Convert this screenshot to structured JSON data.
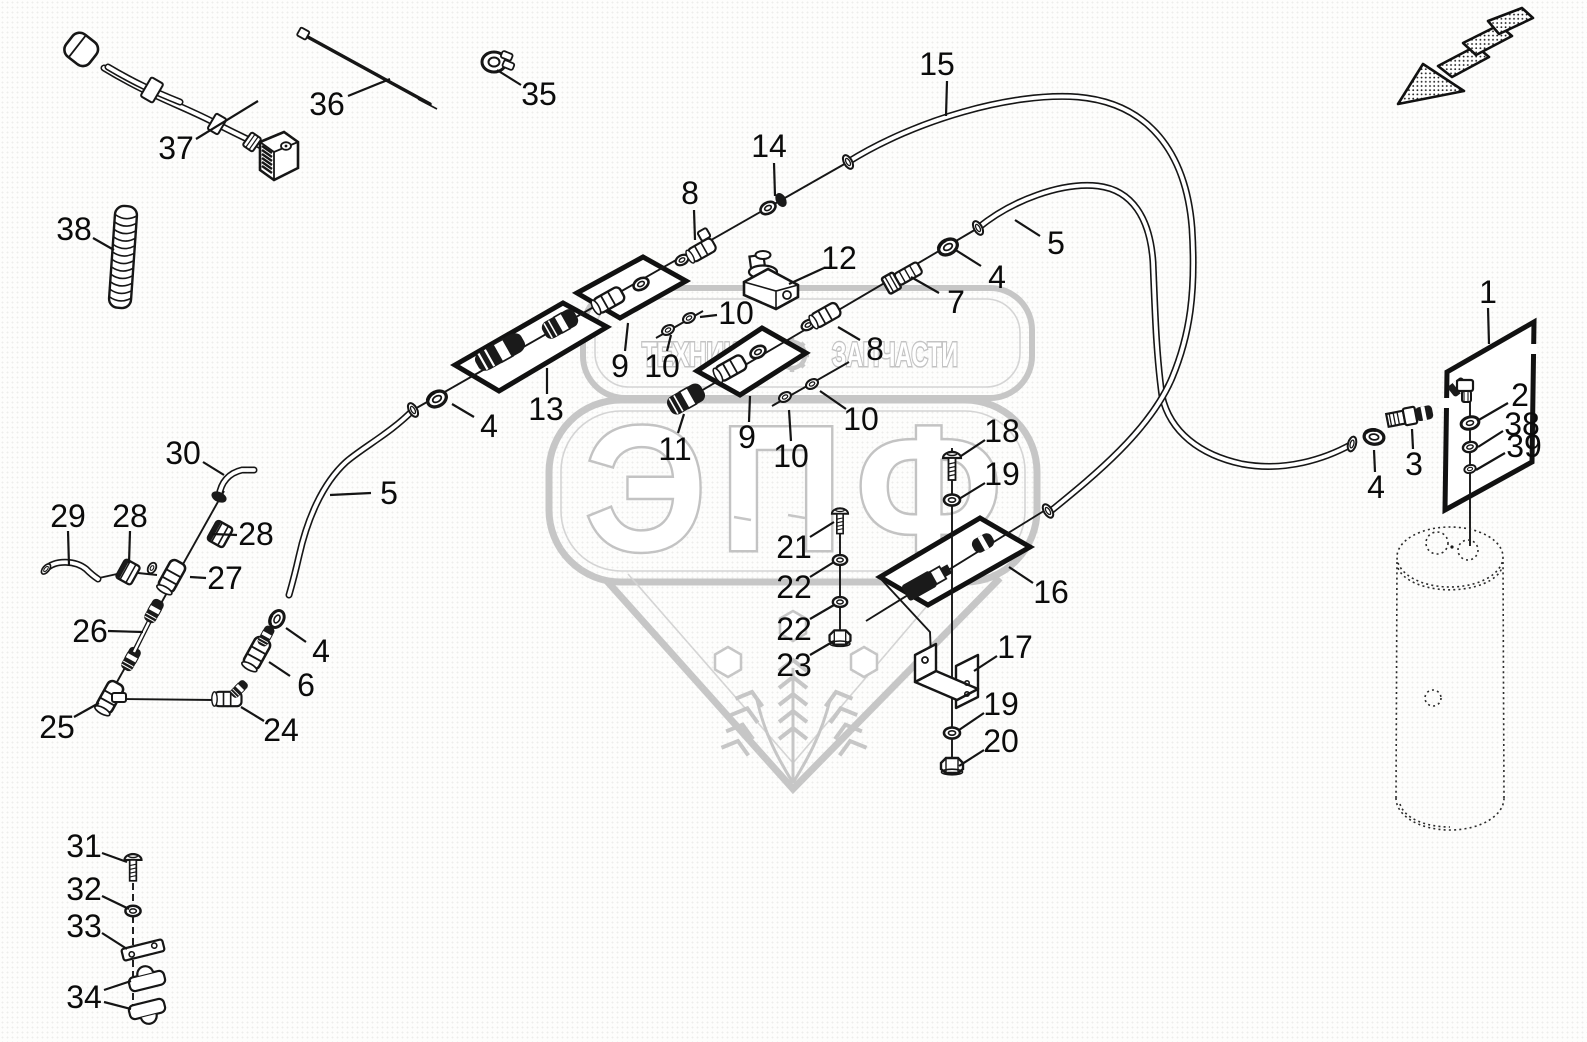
{
  "watermark": {
    "banner_left": "ТЕХНИКА",
    "banner_right": "ЗАПЧАСТИ",
    "brand": "ЭПФ",
    "color": "#c6c6c6"
  },
  "colors": {
    "line": "#161616",
    "label": "#0b0b0b",
    "background": "#fdfdfc"
  },
  "icons": {
    "direction_arrow": "hatched-arrow-down-left"
  },
  "callouts": [
    {
      "n": "37",
      "x": 176,
      "y": 148,
      "l": [
        [
          196,
          139,
          258,
          101
        ]
      ]
    },
    {
      "n": "36",
      "x": 327,
      "y": 104,
      "l": [
        [
          348,
          96,
          390,
          79
        ]
      ]
    },
    {
      "n": "35",
      "x": 539,
      "y": 94,
      "l": [
        [
          521,
          85,
          497,
          70
        ]
      ]
    },
    {
      "n": "38",
      "x": 74,
      "y": 229,
      "l": [
        [
          93,
          238,
          114,
          250
        ]
      ]
    },
    {
      "n": "15",
      "x": 937,
      "y": 64,
      "l": [
        [
          947,
          81,
          946,
          116
        ]
      ]
    },
    {
      "n": "14",
      "x": 769,
      "y": 146,
      "l": [
        [
          774,
          163,
          775,
          196
        ]
      ]
    },
    {
      "n": "8",
      "x": 690,
      "y": 193,
      "l": [
        [
          694,
          210,
          695,
          240
        ]
      ]
    },
    {
      "n": "5",
      "x": 1056,
      "y": 243,
      "l": [
        [
          1040,
          236,
          1015,
          220
        ]
      ]
    },
    {
      "n": "4",
      "x": 997,
      "y": 277,
      "l": [
        [
          981,
          266,
          954,
          249
        ]
      ]
    },
    {
      "n": "7",
      "x": 956,
      "y": 302,
      "l": [
        [
          939,
          293,
          911,
          277
        ]
      ]
    },
    {
      "n": "12",
      "x": 839,
      "y": 258,
      "l": [
        [
          824,
          268,
          789,
          284
        ]
      ]
    },
    {
      "n": "8",
      "x": 875,
      "y": 349,
      "l": [
        [
          860,
          340,
          838,
          327
        ]
      ]
    },
    {
      "n": "10",
      "x": 736,
      "y": 313,
      "l": [
        [
          717,
          315,
          700,
          317
        ]
      ]
    },
    {
      "n": "10",
      "x": 662,
      "y": 366,
      "l": [
        [
          667,
          351,
          671,
          335
        ]
      ]
    },
    {
      "n": "9",
      "x": 620,
      "y": 366,
      "l": [
        [
          625,
          351,
          628,
          323
        ]
      ]
    },
    {
      "n": "13",
      "x": 546,
      "y": 409,
      "l": [
        [
          547,
          394,
          547,
          368
        ]
      ]
    },
    {
      "n": "4",
      "x": 489,
      "y": 426,
      "l": [
        [
          474,
          417,
          452,
          404
        ]
      ]
    },
    {
      "n": "5",
      "x": 389,
      "y": 493,
      "l": [
        [
          371,
          493,
          330,
          495
        ]
      ]
    },
    {
      "n": "11",
      "x": 675,
      "y": 449,
      "l": [
        [
          678,
          433,
          684,
          414
        ]
      ]
    },
    {
      "n": "9",
      "x": 747,
      "y": 437,
      "l": [
        [
          749,
          422,
          750,
          396
        ]
      ]
    },
    {
      "n": "10",
      "x": 791,
      "y": 456,
      "l": [
        [
          791,
          441,
          789,
          410
        ]
      ]
    },
    {
      "n": "10",
      "x": 861,
      "y": 419,
      "l": [
        [
          846,
          409,
          820,
          391
        ]
      ]
    },
    {
      "n": "30",
      "x": 183,
      "y": 453,
      "l": [
        [
          203,
          462,
          224,
          475
        ]
      ]
    },
    {
      "n": "29",
      "x": 68,
      "y": 516,
      "l": [
        [
          68,
          531,
          69,
          566
        ]
      ]
    },
    {
      "n": "28",
      "x": 130,
      "y": 516,
      "l": [
        [
          130,
          531,
          129,
          563
        ]
      ]
    },
    {
      "n": "28",
      "x": 256,
      "y": 534,
      "l": [
        [
          237,
          535,
          212,
          534
        ]
      ]
    },
    {
      "n": "27",
      "x": 225,
      "y": 578,
      "l": [
        [
          206,
          578,
          190,
          577
        ]
      ]
    },
    {
      "n": "26",
      "x": 90,
      "y": 631,
      "l": [
        [
          108,
          631,
          143,
          632
        ]
      ]
    },
    {
      "n": "4",
      "x": 321,
      "y": 651,
      "l": [
        [
          306,
          642,
          286,
          628
        ]
      ]
    },
    {
      "n": "6",
      "x": 306,
      "y": 685,
      "l": [
        [
          290,
          676,
          269,
          662
        ]
      ]
    },
    {
      "n": "25",
      "x": 57,
      "y": 727,
      "l": [
        [
          74,
          717,
          99,
          703
        ]
      ]
    },
    {
      "n": "24",
      "x": 281,
      "y": 730,
      "l": [
        [
          264,
          721,
          241,
          707
        ]
      ]
    },
    {
      "n": "31",
      "x": 84,
      "y": 846,
      "l": [
        [
          102,
          853,
          127,
          862
        ]
      ]
    },
    {
      "n": "32",
      "x": 84,
      "y": 889,
      "l": [
        [
          102,
          896,
          129,
          909
        ]
      ]
    },
    {
      "n": "33",
      "x": 84,
      "y": 926,
      "l": [
        [
          102,
          933,
          127,
          949
        ]
      ]
    },
    {
      "n": "34",
      "x": 84,
      "y": 997,
      "l": [
        [
          104,
          990,
          131,
          981
        ],
        [
          104,
          1002,
          131,
          1009
        ]
      ]
    },
    {
      "n": "18",
      "x": 1002,
      "y": 431,
      "l": [
        [
          985,
          440,
          961,
          456
        ]
      ]
    },
    {
      "n": "19",
      "x": 1002,
      "y": 474,
      "l": [
        [
          985,
          483,
          959,
          499
        ]
      ]
    },
    {
      "n": "16",
      "x": 1051,
      "y": 592,
      "l": [
        [
          1033,
          583,
          1009,
          567
        ]
      ]
    },
    {
      "n": "21",
      "x": 794,
      "y": 547,
      "l": [
        [
          810,
          537,
          834,
          522
        ]
      ]
    },
    {
      "n": "22",
      "x": 794,
      "y": 587,
      "l": [
        [
          810,
          577,
          834,
          562
        ]
      ]
    },
    {
      "n": "22",
      "x": 794,
      "y": 629,
      "l": [
        [
          810,
          619,
          834,
          605
        ]
      ]
    },
    {
      "n": "23",
      "x": 794,
      "y": 665,
      "l": [
        [
          810,
          655,
          834,
          641
        ]
      ]
    },
    {
      "n": "17",
      "x": 1015,
      "y": 647,
      "l": [
        [
          997,
          656,
          974,
          671
        ]
      ]
    },
    {
      "n": "19",
      "x": 1001,
      "y": 704,
      "l": [
        [
          984,
          713,
          959,
          730
        ]
      ]
    },
    {
      "n": "20",
      "x": 1001,
      "y": 741,
      "l": [
        [
          984,
          750,
          959,
          766
        ]
      ]
    },
    {
      "n": "1",
      "x": 1488,
      "y": 292,
      "l": [
        [
          1488,
          308,
          1489,
          344
        ]
      ]
    },
    {
      "n": "2",
      "x": 1520,
      "y": 395,
      "l": [
        [
          1508,
          403,
          1477,
          421
        ]
      ]
    },
    {
      "n": "38",
      "x": 1522,
      "y": 424,
      "l": [
        [
          1503,
          431,
          1478,
          447
        ]
      ]
    },
    {
      "n": "39",
      "x": 1524,
      "y": 446,
      "l": [
        [
          1505,
          453,
          1476,
          470
        ]
      ]
    },
    {
      "n": "3",
      "x": 1414,
      "y": 464,
      "l": [
        [
          1413,
          449,
          1412,
          429
        ]
      ]
    },
    {
      "n": "4",
      "x": 1376,
      "y": 487,
      "l": [
        [
          1375,
          472,
          1374,
          450
        ]
      ]
    }
  ]
}
